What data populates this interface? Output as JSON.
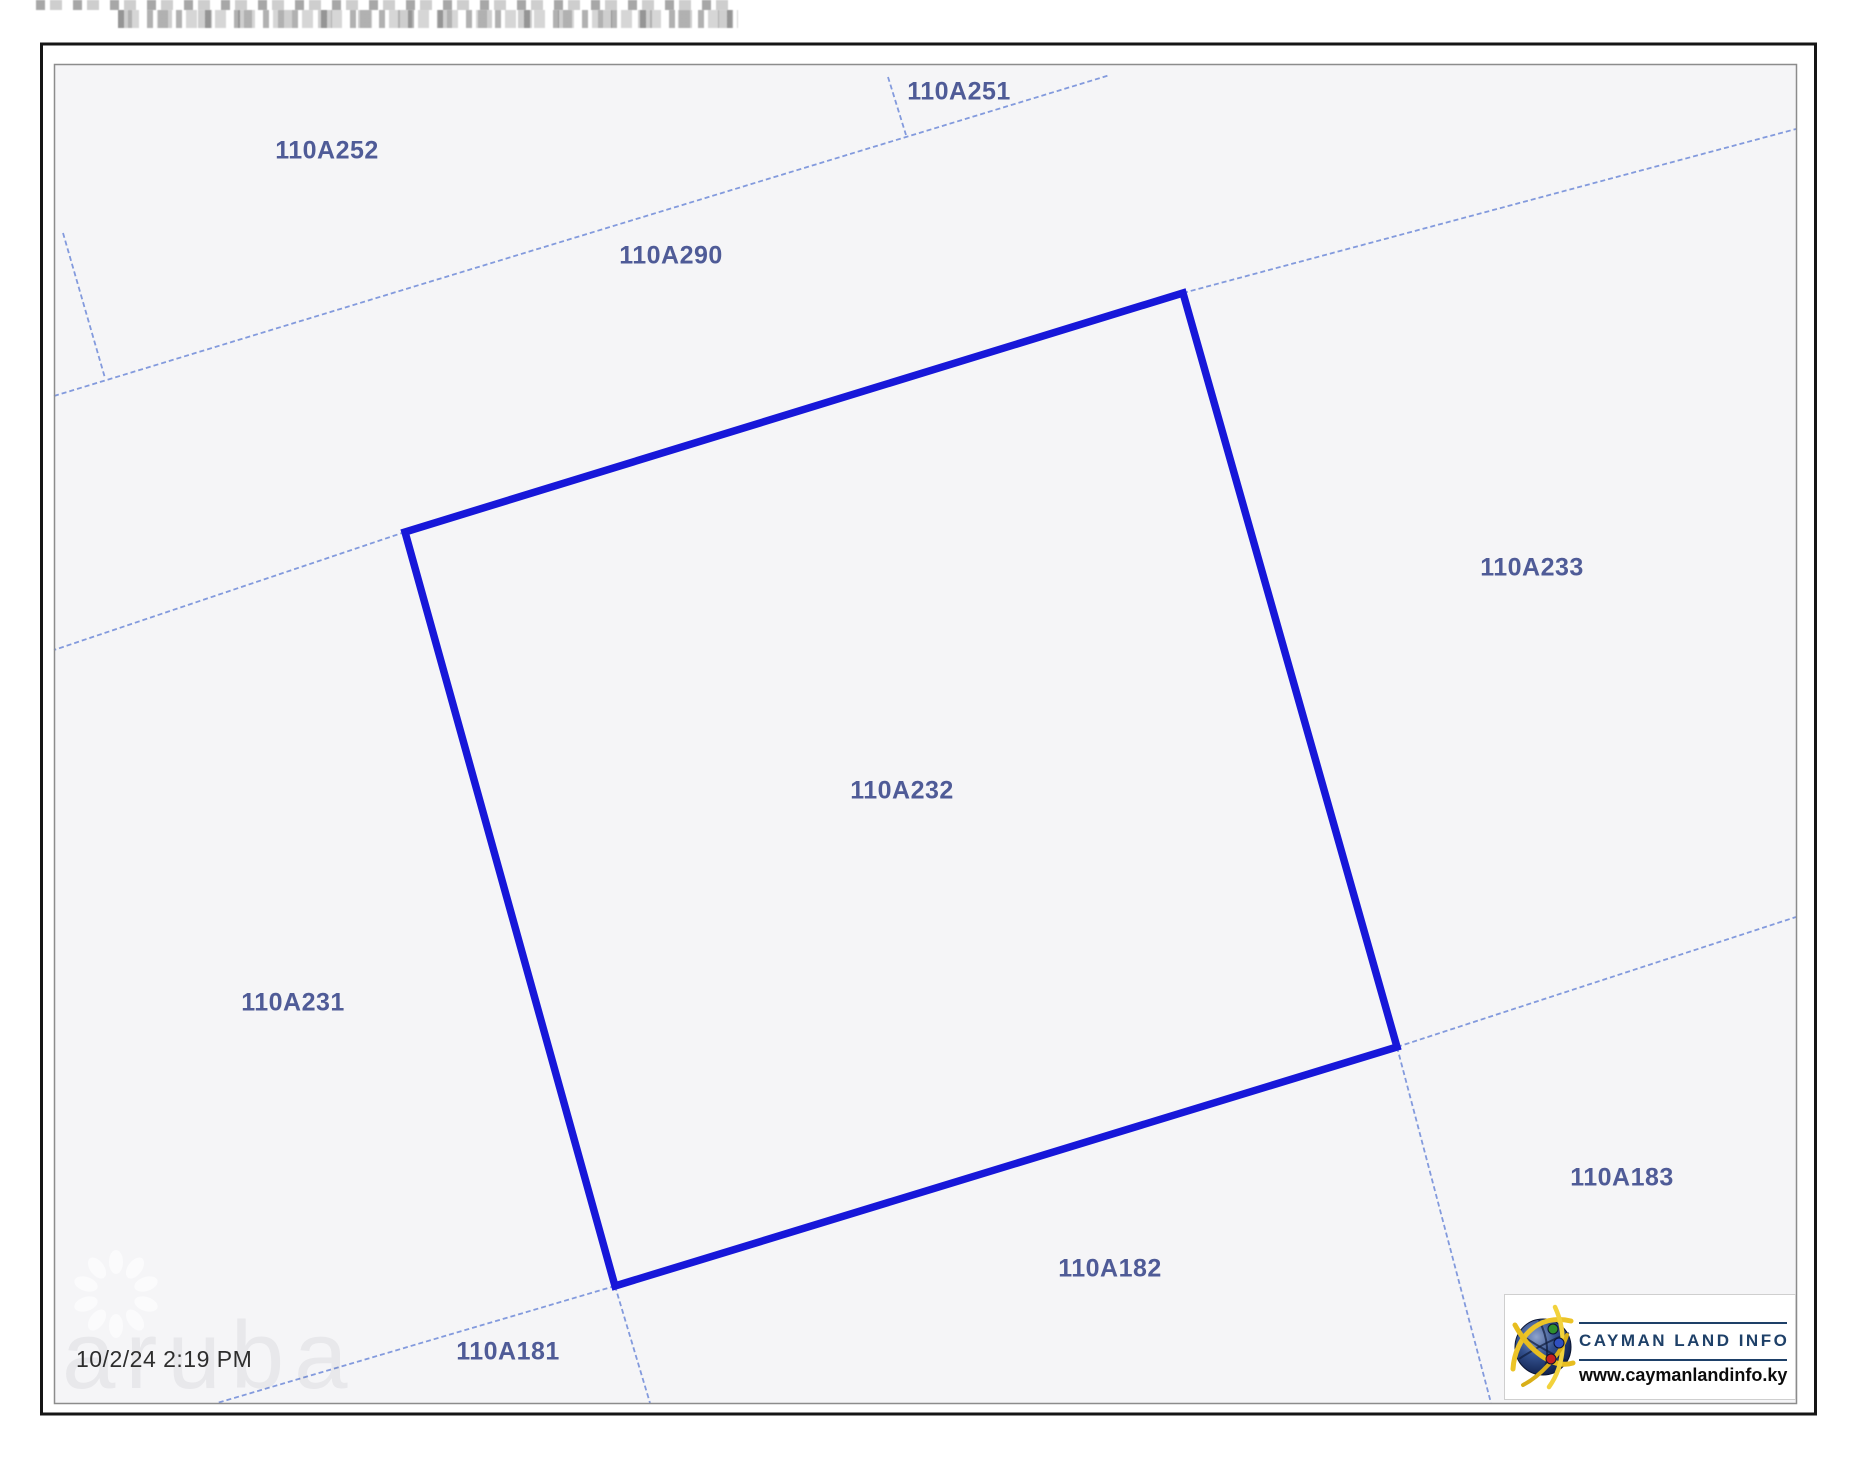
{
  "map": {
    "timestamp": "10/2/24 2:19 PM",
    "selected_parcel_id": "110A232",
    "parcels": [
      {
        "id": "110A252",
        "x": 327,
        "y": 151
      },
      {
        "id": "110A251",
        "x": 959,
        "y": 92
      },
      {
        "id": "110A290",
        "x": 671,
        "y": 256
      },
      {
        "id": "110A233",
        "x": 1532,
        "y": 568
      },
      {
        "id": "110A232",
        "x": 902,
        "y": 791,
        "selected": true
      },
      {
        "id": "110A231",
        "x": 293,
        "y": 1003
      },
      {
        "id": "110A181",
        "x": 508,
        "y": 1352
      },
      {
        "id": "110A182",
        "x": 1110,
        "y": 1269
      },
      {
        "id": "110A183",
        "x": 1622,
        "y": 1178
      }
    ]
  },
  "logo": {
    "title": "CAYMAN LAND INFO",
    "url": "www.caymanlandinfo.ky",
    "icon": "globe-icon"
  },
  "watermark": {
    "text": "aruba",
    "icon": "flower-spinner-icon"
  },
  "colors": {
    "selected_boundary": "#1717d9",
    "parcel_line": "#7d96dc",
    "parcel_label": "#4f5b97",
    "map_background": "#f5f5f7",
    "frame_dark": "#161616",
    "frame_light": "#8c8c8c",
    "logo_navy": "#1e4068",
    "timestamp_text": "#2e2e2e"
  }
}
